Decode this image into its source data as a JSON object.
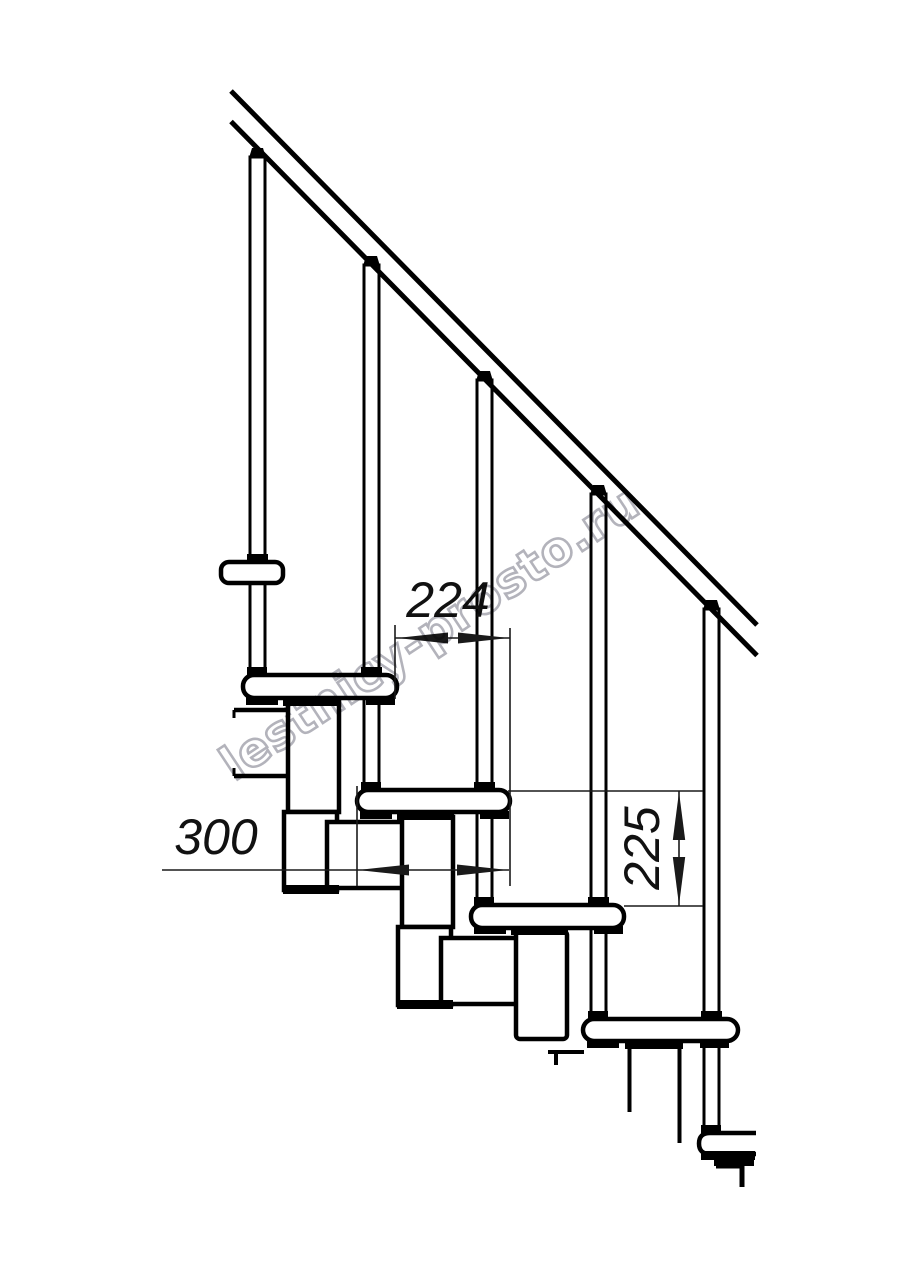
{
  "drawing": {
    "type": "technical-drawing",
    "subject": "modular staircase side elevation",
    "colors": {
      "line": "#000000",
      "dimension_line": "#1a1a1a",
      "watermark": "#a6a6af",
      "background": "#ffffff"
    },
    "dimensions": {
      "step_run": {
        "value": "224",
        "orientation": "horizontal"
      },
      "tread_depth": {
        "value": "300",
        "orientation": "horizontal"
      },
      "step_rise": {
        "value": "225",
        "orientation": "vertical"
      }
    },
    "watermark": {
      "text": "lestnicy-prosto.ru"
    }
  }
}
